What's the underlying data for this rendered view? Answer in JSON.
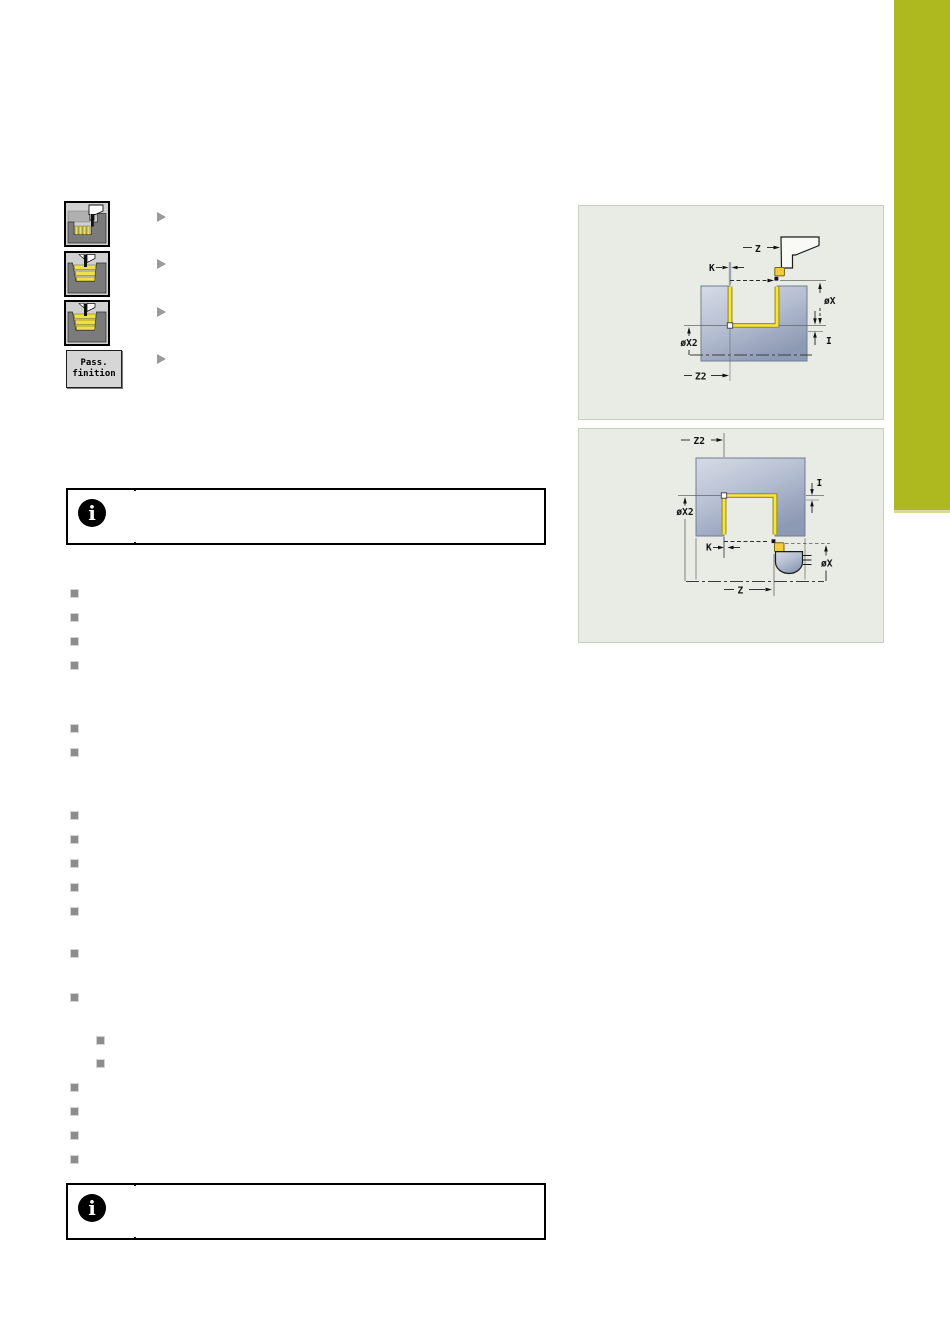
{
  "colors": {
    "chapter_tab_green": "#adb91f",
    "diagram_panel_background": "#e9ece5",
    "workpiece_blue_light": "#d6dbe6",
    "workpiece_blue_dark": "#8d9ab4",
    "contour_highlight_yellow": "#f4e64a",
    "softkey_icon_yellow": "#eee04d",
    "bullet_gray": "#8d8d8d"
  },
  "softkeys": {
    "button": {
      "line1": "Pass.",
      "line2": "finition"
    },
    "icons": [
      {
        "name": "recess-roughing-cycle-icon"
      },
      {
        "name": "recess-finishing-cycle-icon"
      },
      {
        "name": "recess-finishing-extended-cycle-icon"
      }
    ]
  },
  "notes": {
    "icon_glyph": "i"
  },
  "diagrams": [
    {
      "name": "recess-finishing-external-diagram",
      "labels": {
        "z": "Z",
        "k": "K",
        "ox": "øX",
        "i": "I",
        "ox2": "øX2",
        "z2": "Z2"
      }
    },
    {
      "name": "recess-finishing-internal-diagram",
      "labels": {
        "z2": "Z2",
        "i": "I",
        "ox2": "øX2",
        "k": "K",
        "ox": "øX",
        "z": "Z"
      }
    }
  ]
}
